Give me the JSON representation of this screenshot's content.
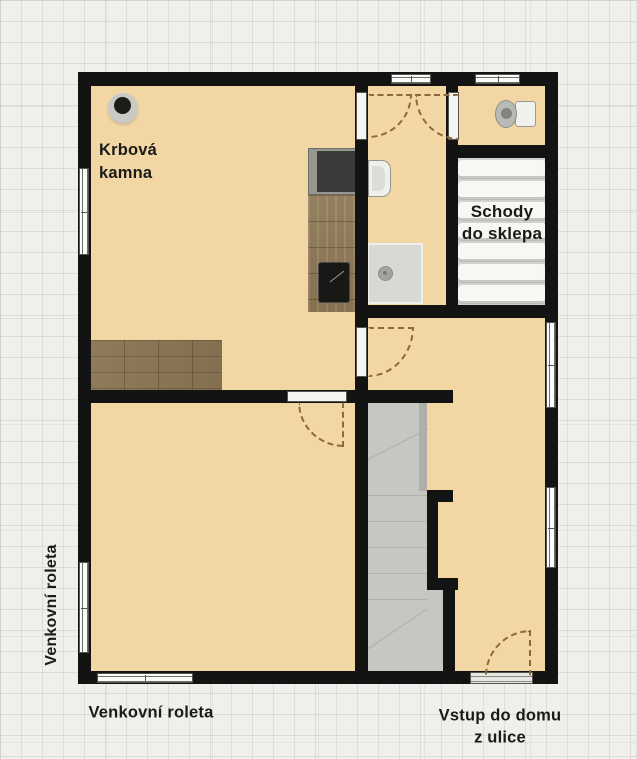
{
  "labels": {
    "fireplace": [
      "Krbová",
      "kamna"
    ],
    "basement_stairs": [
      "Schody",
      "do sklepa"
    ],
    "left_shutter": "Venkovní roleta",
    "bottom_shutter": "Venkovní roleta",
    "entrance": [
      "Vstup do domu",
      "z ulice"
    ]
  },
  "colors": {
    "wall": "#131313",
    "floor": "#f2d7a5",
    "paper": "#f1efeb",
    "stairs_up": "#c6c6c3",
    "wood": "#8c7758",
    "door_arc": "#8a6a3c"
  },
  "fixtures": [
    "fireplace-stove",
    "kitchen-stove",
    "kitchen-sink",
    "kitchen-counter",
    "bar-counter",
    "washbasin",
    "shower",
    "toilet",
    "stairs-up",
    "basement-stairs"
  ]
}
